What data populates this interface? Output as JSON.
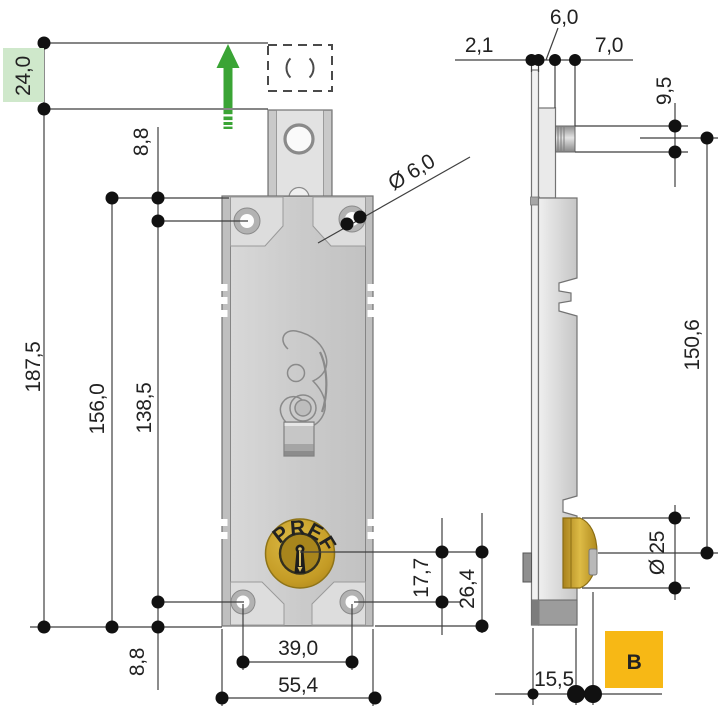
{
  "page": {
    "title": "Roller shutter lock technical drawing"
  },
  "front": {
    "brand": "PREFER",
    "dims": {
      "travel": "24,0",
      "total_height": "187,5",
      "case_height": "156,0",
      "hole_spacing_vertical": "138,5",
      "top_hole_offset": "8,8",
      "bottom_hole_offset": "8,8",
      "screw_hole_diameter": "Ø 6,0",
      "hole_spacing_horizontal": "39,0",
      "case_width": "55,4",
      "cylinder_to_hole": "17,7",
      "cylinder_to_edge": "26,4"
    }
  },
  "side": {
    "dims": {
      "plate_thickness": "2,1",
      "plate_offset": "6,0",
      "pin_length": "7,0",
      "pin_diameter": "9,5",
      "pin_to_cylinder": "150,6",
      "cylinder_diameter": "Ø 25",
      "foot_depth": "15,5"
    }
  },
  "badge": {
    "variant": "B"
  },
  "colors": {
    "accent_green": "#3aa435",
    "highlight_green_bg": "#cfe8cb",
    "brass": "#c49b25",
    "badge_orange": "#f7b815",
    "line": "#3f3f3f"
  }
}
